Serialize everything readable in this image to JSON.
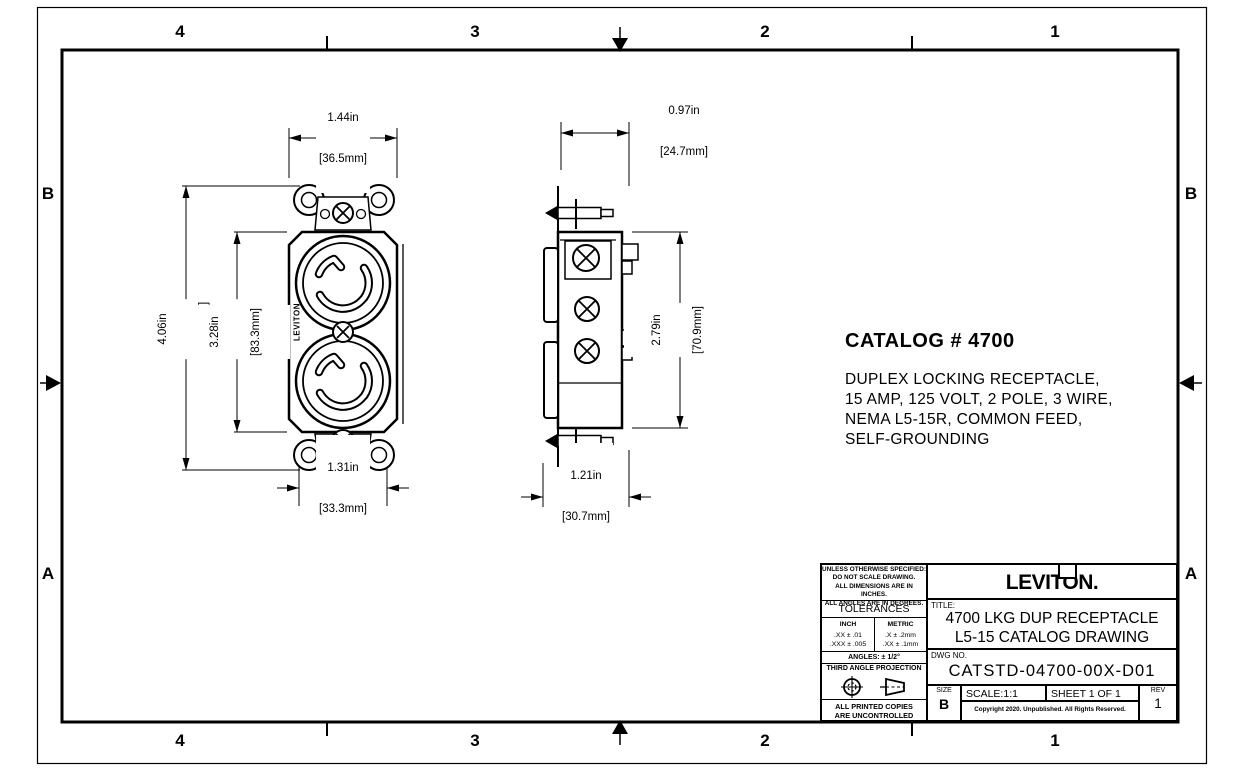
{
  "zones": {
    "columns": [
      "4",
      "3",
      "2",
      "1"
    ],
    "rows": [
      "B",
      "A"
    ]
  },
  "device": {
    "brand_vertical": "LEVITON"
  },
  "dims": {
    "front_width": {
      "in": "1.44in",
      "mm": "[36.5mm]"
    },
    "front_height": {
      "in": "4.06in",
      "mm": "[103.2mm]"
    },
    "front_body_height": {
      "in": "3.28in",
      "mm": "[83.3mm]"
    },
    "front_strap_width": {
      "in": "1.31in",
      "mm": "[33.3mm]"
    },
    "side_depth": {
      "in": "0.97in",
      "mm": "[24.7mm]"
    },
    "side_body_height": {
      "in": "2.79in",
      "mm": "[70.9mm]"
    },
    "side_base_depth": {
      "in": "1.21in",
      "mm": "[30.7mm]"
    }
  },
  "notes": {
    "catalog_title": "CATALOG # 4700",
    "description_lines": [
      "DUPLEX LOCKING RECEPTACLE,",
      "15 AMP, 125 VOLT, 2 POLE, 3 WIRE,",
      "NEMA L5-15R, COMMON FEED,",
      "SELF-GROUNDING"
    ]
  },
  "title_block": {
    "spec_note_lines": [
      "UNLESS OTHERWISE SPECIFIED:",
      "DO NOT SCALE DRAWING.",
      "ALL DIMENSIONS ARE IN INCHES.",
      "ALL ANGLES ARE IN DEGREES."
    ],
    "tolerances_header": "TOLERANCES",
    "inch_header": "INCH",
    "metric_header": "METRIC",
    "inch_rows": [
      ".XX  ±  .01",
      ".XXX ±  .005"
    ],
    "metric_rows": [
      ".X   ±  .2mm",
      ".XX  ±  .1mm"
    ],
    "angles": "ANGLES: ± 1/2°",
    "projection": "THIRD ANGLE PROJECTION",
    "uncontrolled_lines": [
      "ALL PRINTED COPIES",
      "ARE UNCONTROLLED"
    ],
    "brand": "LEVITON.",
    "title_label": "TITLE:",
    "title_lines": [
      "4700 LKG DUP RECEPTACLE",
      "L5-15 CATALOG DRAWING"
    ],
    "dwg_label": "DWG NO.",
    "dwg_no": "CATSTD-04700-00X-D01",
    "size_label": "SIZE",
    "size_value": "B",
    "scale": "SCALE:1:1",
    "sheet": "SHEET 1 OF 1",
    "rev_label": "REV",
    "rev_value": "1",
    "copyright": "Copyright 2020. Unpublished. All Rights Reserved."
  }
}
